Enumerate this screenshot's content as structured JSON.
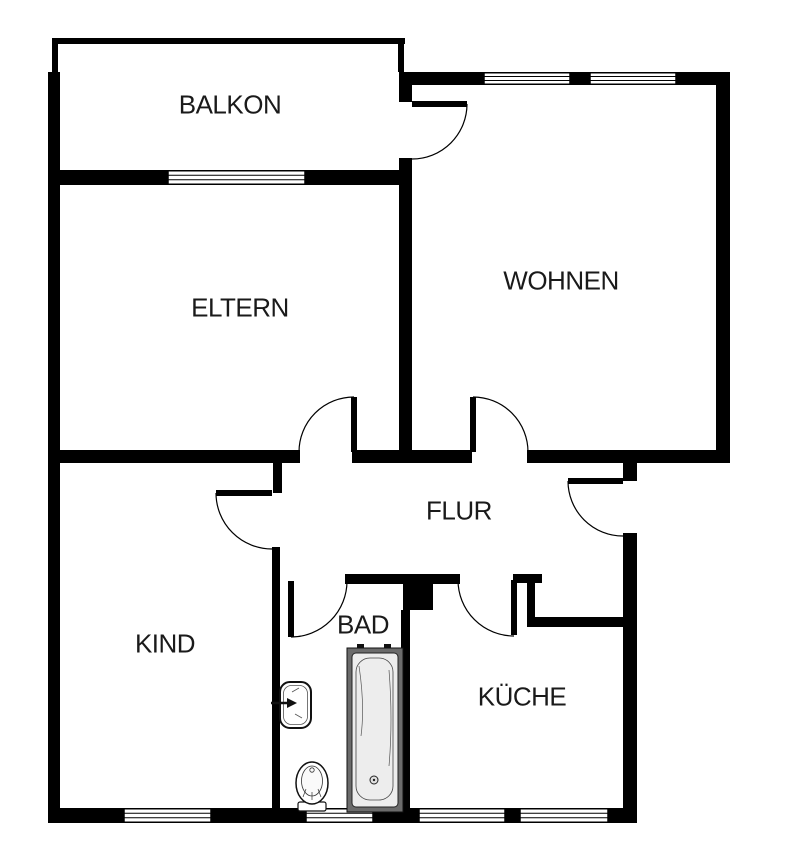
{
  "canvas": {
    "width": 790,
    "height": 863,
    "bg": "#ffffff",
    "wall_color": "#000000",
    "line_color": "#000000",
    "text_color": "#1a1a1a",
    "fixture_frame": "#6b6b6b",
    "fixture_fill": "#ededed"
  },
  "rooms": [
    {
      "id": "balkon",
      "label": "BALKON",
      "x": 230,
      "y": 105
    },
    {
      "id": "eltern",
      "label": "ELTERN",
      "x": 240,
      "y": 308
    },
    {
      "id": "wohnen",
      "label": "WOHNEN",
      "x": 561,
      "y": 281
    },
    {
      "id": "flur",
      "label": "FLUR",
      "x": 459,
      "y": 511
    },
    {
      "id": "kind",
      "label": "KIND",
      "x": 165,
      "y": 644
    },
    {
      "id": "bad",
      "label": "BAD",
      "x": 363,
      "y": 625
    },
    {
      "id": "kueche",
      "label": "KÜCHE",
      "x": 522,
      "y": 697
    }
  ],
  "walls": [
    {
      "id": "balcony-parapet-top",
      "x": 52,
      "y": 38,
      "w": 353,
      "h": 6
    },
    {
      "id": "balcony-parapet-left",
      "x": 52,
      "y": 44,
      "w": 6,
      "h": 28
    },
    {
      "id": "balcony-parapet-right",
      "x": 398,
      "y": 44,
      "w": 6,
      "h": 28
    },
    {
      "id": "outer-wall-left",
      "x": 48,
      "y": 72,
      "w": 12,
      "h": 751
    },
    {
      "id": "balcony-inner-wall-west",
      "x": 48,
      "y": 170,
      "w": 120,
      "h": 15
    },
    {
      "id": "balcony-inner-wall-east",
      "x": 305,
      "y": 170,
      "w": 106,
      "h": 15
    },
    {
      "id": "wohnen-top-wall-a",
      "x": 403,
      "y": 72,
      "w": 81,
      "h": 13
    },
    {
      "id": "wohnen-top-wall-pier",
      "x": 570,
      "y": 72,
      "w": 20,
      "h": 13
    },
    {
      "id": "wohnen-top-wall-b",
      "x": 676,
      "y": 72,
      "w": 54,
      "h": 13
    },
    {
      "id": "outer-wall-right",
      "x": 716,
      "y": 72,
      "w": 14,
      "h": 391
    },
    {
      "id": "eltern-wohnen-wall-top",
      "x": 399,
      "y": 72,
      "w": 13,
      "h": 30
    },
    {
      "id": "eltern-wohnen-wall",
      "x": 399,
      "y": 158,
      "w": 13,
      "h": 305
    },
    {
      "id": "flur-north-wall-west",
      "x": 60,
      "y": 450,
      "w": 240,
      "h": 13
    },
    {
      "id": "kind-door-stub",
      "x": 273,
      "y": 450,
      "w": 9,
      "h": 43
    },
    {
      "id": "flur-north-wall-mid",
      "x": 352,
      "y": 450,
      "w": 120,
      "h": 13
    },
    {
      "id": "flur-north-wall-east",
      "x": 527,
      "y": 450,
      "w": 203,
      "h": 13
    },
    {
      "id": "entry-wall-block",
      "x": 623,
      "y": 450,
      "w": 14,
      "h": 31
    },
    {
      "id": "outer-wall-east",
      "x": 623,
      "y": 533,
      "w": 14,
      "h": 290
    },
    {
      "id": "kind-bad-wall",
      "x": 272,
      "y": 547,
      "w": 8,
      "h": 261
    },
    {
      "id": "bad-top-wall-west",
      "x": 345,
      "y": 574,
      "w": 58,
      "h": 10
    },
    {
      "id": "duct-block",
      "x": 403,
      "y": 574,
      "w": 30,
      "h": 36
    },
    {
      "id": "bad-top-wall-east",
      "x": 433,
      "y": 574,
      "w": 27,
      "h": 10
    },
    {
      "id": "kueche-top-stub",
      "x": 513,
      "y": 574,
      "w": 29,
      "h": 9
    },
    {
      "id": "kueche-step-wall",
      "x": 527,
      "y": 583,
      "w": 8,
      "h": 40
    },
    {
      "id": "kueche-top-wall",
      "x": 527,
      "y": 617,
      "w": 96,
      "h": 10
    },
    {
      "id": "bad-kueche-wall",
      "x": 401,
      "y": 610,
      "w": 9,
      "h": 198
    },
    {
      "id": "bottom-wall-a",
      "x": 48,
      "y": 808,
      "w": 76,
      "h": 15
    },
    {
      "id": "bottom-wall-b",
      "x": 211,
      "y": 808,
      "w": 95,
      "h": 15
    },
    {
      "id": "bottom-wall-c",
      "x": 373,
      "y": 808,
      "w": 46,
      "h": 15
    },
    {
      "id": "bottom-wall-d",
      "x": 505,
      "y": 808,
      "w": 15,
      "h": 15
    },
    {
      "id": "bottom-wall-e",
      "x": 608,
      "y": 808,
      "w": 29,
      "h": 15
    }
  ],
  "windows": [
    {
      "id": "eltern-window",
      "x": 168,
      "y": 170,
      "w": 137,
      "h": 15
    },
    {
      "id": "wohnen-window-left",
      "x": 484,
      "y": 72,
      "w": 86,
      "h": 13
    },
    {
      "id": "wohnen-window-right",
      "x": 590,
      "y": 72,
      "w": 86,
      "h": 13
    },
    {
      "id": "kind-window",
      "x": 124,
      "y": 808,
      "w": 87,
      "h": 15
    },
    {
      "id": "bad-window",
      "x": 306,
      "y": 808,
      "w": 67,
      "h": 15
    },
    {
      "id": "kueche-window-left",
      "x": 419,
      "y": 808,
      "w": 86,
      "h": 15
    },
    {
      "id": "kueche-window-right",
      "x": 520,
      "y": 808,
      "w": 88,
      "h": 15
    }
  ],
  "doors": [
    {
      "id": "balcony-door",
      "leaf": [
        412,
        104,
        467,
        104
      ],
      "arc": {
        "sx": 467,
        "sy": 104,
        "r": 55,
        "ex": 412,
        "ey": 159,
        "sweep": 1
      }
    },
    {
      "id": "eltern-door",
      "leaf": [
        354,
        397,
        354,
        452
      ],
      "arc": {
        "sx": 354,
        "sy": 397,
        "r": 55,
        "ex": 299,
        "ey": 452,
        "sweep": 0
      }
    },
    {
      "id": "wohnen-door",
      "leaf": [
        473,
        397,
        473,
        452
      ],
      "arc": {
        "sx": 473,
        "sy": 397,
        "r": 55,
        "ex": 528,
        "ey": 452,
        "sweep": 1
      }
    },
    {
      "id": "entry-door",
      "leaf": [
        568,
        481,
        623,
        481
      ],
      "arc": {
        "sx": 568,
        "sy": 481,
        "r": 55,
        "ex": 623,
        "ey": 536,
        "sweep": 0
      }
    },
    {
      "id": "kind-door",
      "leaf": [
        216,
        493,
        272,
        493
      ],
      "arc": {
        "sx": 216,
        "sy": 493,
        "r": 56,
        "ex": 272,
        "ey": 549,
        "sweep": 0
      }
    },
    {
      "id": "bad-door",
      "leaf": [
        291,
        581,
        291,
        637
      ],
      "arc": {
        "sx": 291,
        "sy": 637,
        "r": 56,
        "ex": 347,
        "ey": 581,
        "sweep": 0
      }
    },
    {
      "id": "kueche-door",
      "leaf": [
        514,
        580,
        514,
        635
      ],
      "arc": {
        "sx": 458,
        "sy": 580,
        "r": 56,
        "ex": 514,
        "ey": 636,
        "sweep": 0
      }
    }
  ],
  "fixtures": {
    "bathtub": {
      "x": 347,
      "y": 648,
      "w": 56,
      "h": 164,
      "drain_x": 374,
      "drain_y": 780
    },
    "sink": {
      "x": 280,
      "y": 682,
      "w": 31,
      "h": 46,
      "tap_y": 703
    },
    "toilet": {
      "cx": 312,
      "cy": 783
    }
  }
}
